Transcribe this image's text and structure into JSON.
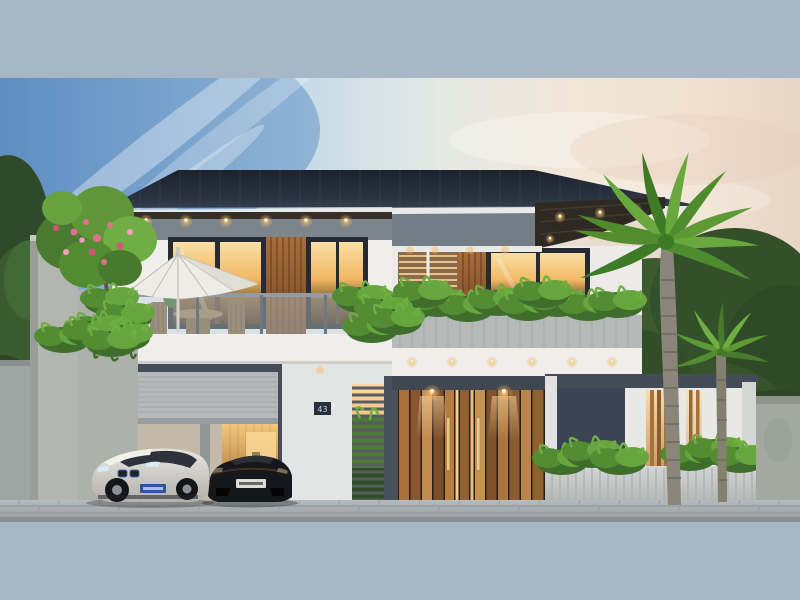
{
  "meta": {
    "title": "Modern two-story villa exterior 3D render at dusk",
    "domain": "Natural-Image"
  },
  "scene": {
    "house_number": "43",
    "time_of_day": "dusk",
    "objects": [
      "dark hip roof with lit soffit downlights",
      "second-floor balcony with glass railing",
      "white patio umbrella with wooden dining set",
      "warm-lit floor-to-ceiling windows with wood slat panels",
      "long concrete planter box with tropical plants",
      "double garage with rolled-up sectional shutter",
      "white BMW i8 sports car",
      "black sports car",
      "house number plaque 43 on white pillar",
      "vertical wood plank entrance gate with warm lights",
      "louvered privacy screen with plants",
      "modern fence: dark panel, white panel with backlit slats, concrete base",
      "frangipani tree with pink blossoms on left boundary wall",
      "two palm trees on the right",
      "gray brick street pavement"
    ]
  },
  "palette": {
    "letterbox": "#a8b7c5",
    "sky_blue": "#5b8cc4",
    "sky_cream": "#f3e8da",
    "roof": "#232b37",
    "wall_white": "#f0efec",
    "window_glow": "#f2b863",
    "wood": "#9a6434",
    "foliage": "#4f8c2e",
    "glass_railing": "#bcd0dc",
    "pavement": "#a7adb0",
    "plaque": "#27303c"
  }
}
